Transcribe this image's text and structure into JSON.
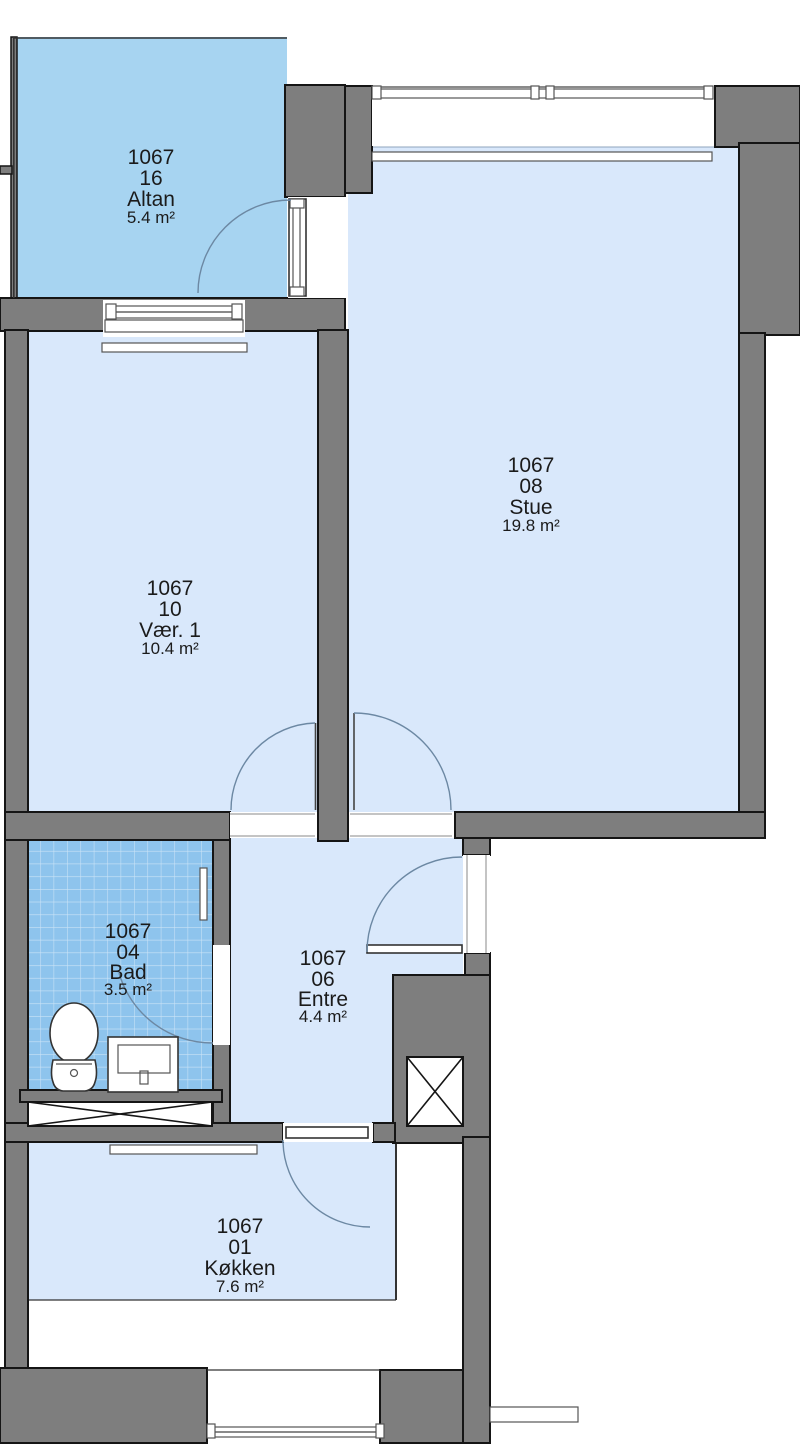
{
  "plan": {
    "title": "Apartment floor plan",
    "unit": "1067",
    "rooms": [
      {
        "unit": "1067",
        "number": "16",
        "name": "Altan",
        "area": "5.4 m²"
      },
      {
        "unit": "1067",
        "number": "08",
        "name": "Stue",
        "area": "19.8 m²"
      },
      {
        "unit": "1067",
        "number": "10",
        "name": "Vær. 1",
        "area": "10.4 m²"
      },
      {
        "unit": "1067",
        "number": "04",
        "name": "Bad",
        "area": "3.5 m²"
      },
      {
        "unit": "1067",
        "number": "06",
        "name": "Entre",
        "area": "4.4 m²"
      },
      {
        "unit": "1067",
        "number": "01",
        "name": "Køkken",
        "area": "7.6 m²"
      }
    ],
    "colors": {
      "wall": "#7e7e7e",
      "outline": "#151515",
      "room_fill": "#d9e8fb",
      "balcony_fill": "#a7d4f1",
      "bath_tile": "#8ec4ed",
      "door_arc": "#6c88a3",
      "text": "#1b1b1b"
    }
  }
}
